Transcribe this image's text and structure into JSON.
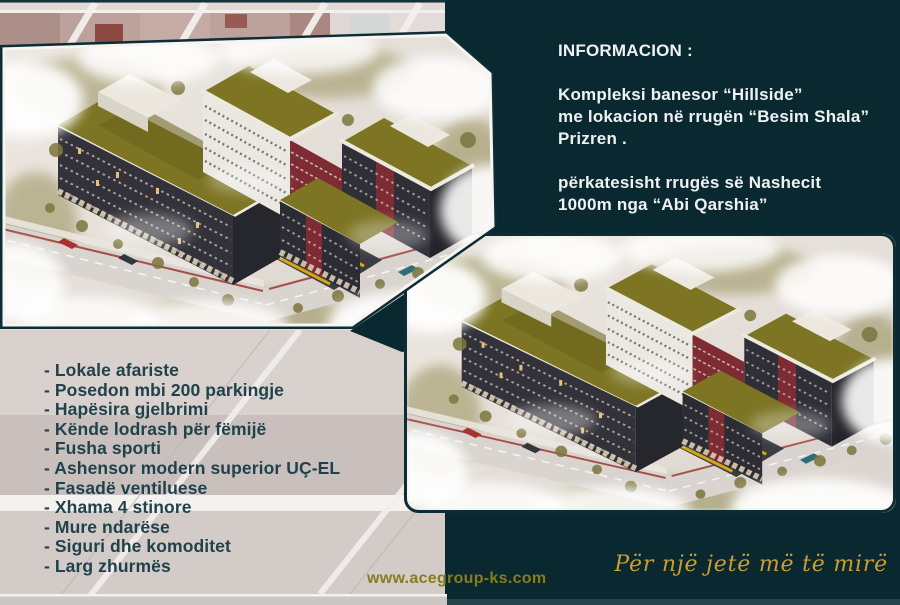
{
  "colors": {
    "teal_background": "#0a2830",
    "slogan_gold": "#c79e33",
    "website_gold": "#8a7a1e",
    "feature_text": "#20424b",
    "roof_green": "#7d7524",
    "facade_maroon": "#7e2b33"
  },
  "info_panel": {
    "title": "INFORMACION :",
    "paragraph1": [
      "Kompleksi banesor “Hillside”",
      "me lokacion në rrugën “Besim Shala”",
      "Prizren ."
    ],
    "paragraph2": [
      "përkatesisht rrugës së Nashecit",
      "1000m nga “Abi Qarshia”"
    ]
  },
  "features": {
    "items": [
      "- Lokale afariste",
      "- Posedon mbi 200 parkingje",
      "- Hapësira gjelbrimi",
      "- Kënde lodrash për fëmijë",
      "- Fusha sporti",
      "- Ashensor modern superior UÇ-EL",
      "- Fasadë ventiluese",
      "- Xhama 4 stinore",
      "- Mure ndarëse",
      "- Siguri dhe komoditet",
      "- Larg zhurmës"
    ]
  },
  "footer": {
    "website": "www.acegroup-ks.com",
    "slogan": "Për një jetë më të mirë"
  }
}
